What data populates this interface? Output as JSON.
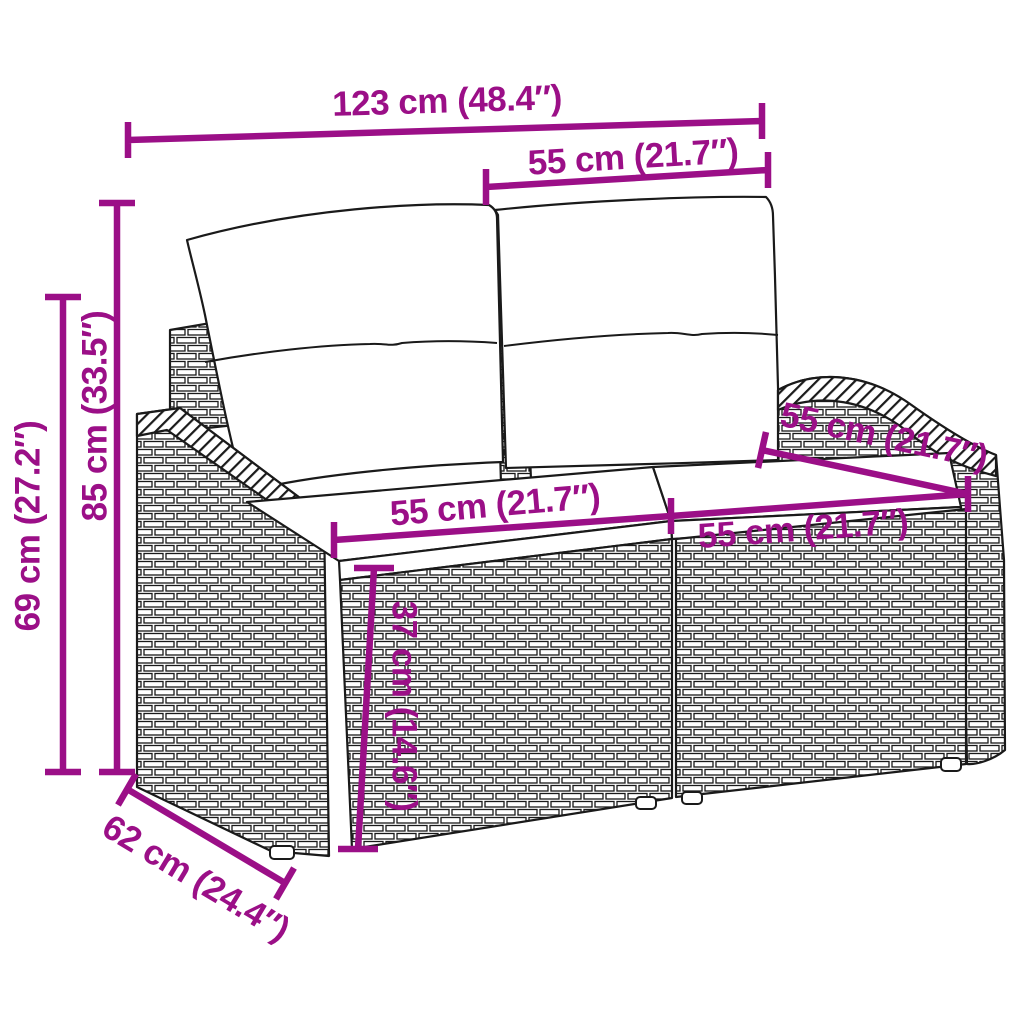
{
  "diagram": {
    "accent_color": "#9B0F87",
    "outline_color": "#1a1a1a",
    "background_color": "#ffffff",
    "subject": "poly-rattan-2-seater-garden-sofa-with-cushions",
    "dimensions": [
      {
        "id": "overall-width",
        "label": "123 cm (48.4″)"
      },
      {
        "id": "backrest-width",
        "label": "55 cm (21.7″)"
      },
      {
        "id": "overall-height",
        "label": "85 cm (33.5″)"
      },
      {
        "id": "armrest-height",
        "label": "69 cm (27.2″)"
      },
      {
        "id": "seat-width-left",
        "label": "55 cm (21.7″)"
      },
      {
        "id": "seat-width-right",
        "label": "55 cm (21.7″)"
      },
      {
        "id": "seat-depth",
        "label": "55 cm (21.7″)"
      },
      {
        "id": "seat-height",
        "label": "37 cm (14.6″)"
      },
      {
        "id": "base-depth",
        "label": "62 cm (24.4″)"
      }
    ]
  }
}
